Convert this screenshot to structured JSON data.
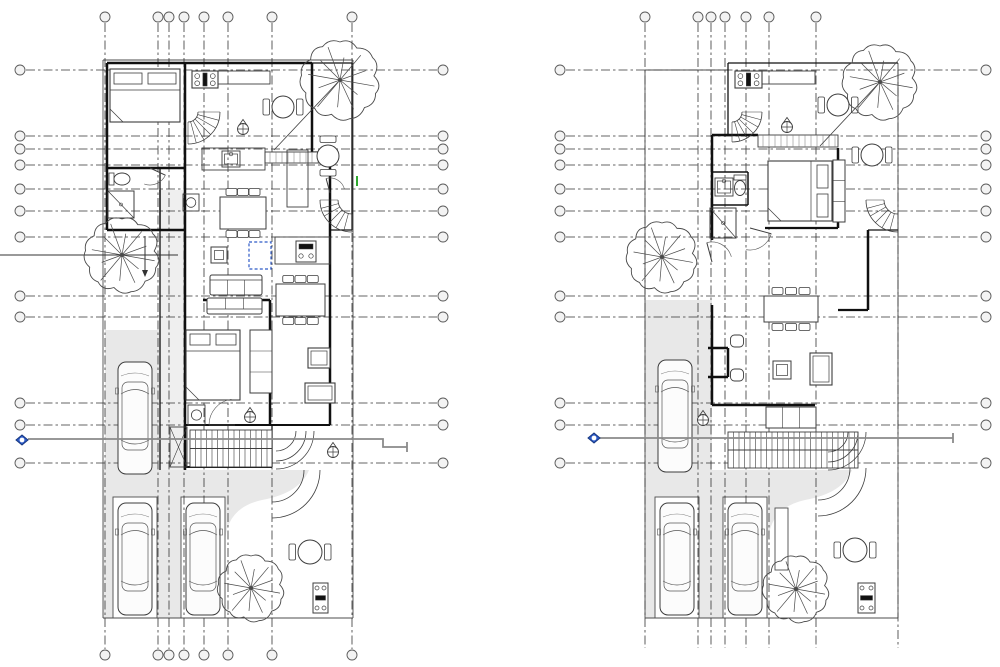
{
  "canvas": {
    "w": 1000,
    "h": 667,
    "bg": "#ffffff"
  },
  "palette": {
    "line": "#2f2f2f",
    "wall": "#101010",
    "furn": "#3d3d3d",
    "site": "#4d4d4d",
    "grid": "#343434",
    "gray_fill": "#e8e8e8",
    "gray_fill_light": "#efefef",
    "section_gray": "#8a8a8a",
    "accent_blue": "#2e5bc7",
    "accent_blue_dark": "#17377e",
    "green": "#18a018",
    "bubble_fill": "#f3f3f3",
    "tree": "#4a4a4a",
    "white": "#ffffff"
  },
  "plans": [
    {
      "name": "first-floor-plan",
      "grid": {
        "vx": [
          105,
          158,
          169,
          184,
          204,
          228,
          272,
          352
        ],
        "v_y1": 23,
        "v_y2": 649,
        "bubble_top_y": 17,
        "bubble_bottom_y": 655,
        "top_bubbles": true,
        "bottom_bubbles": true,
        "hy": [
          70,
          136,
          149,
          165,
          189,
          211,
          237,
          296,
          317,
          403,
          425,
          463
        ],
        "h_x1": 26,
        "h_x2": 437,
        "bubble_left_x": 20,
        "bubble_right_x": 443,
        "extra_dash": []
      },
      "fills": [
        {
          "t": "rect",
          "x": 103,
          "y": 470,
          "w": 250,
          "h": 148,
          "fill": "#e8e8e8"
        },
        {
          "t": "rect",
          "x": 105,
          "y": 330,
          "w": 55,
          "h": 140,
          "fill": "#e8e8e8"
        },
        {
          "t": "rect",
          "x": 160,
          "y": 190,
          "w": 25,
          "h": 280,
          "fill": "#efefef"
        },
        {
          "t": "path",
          "d": "M225,618 L225,545 Q225,508 262,500 Q300,493 309,470 L353,470 L353,618 Z",
          "fill": "#ffffff"
        },
        {
          "t": "rect",
          "x": 113,
          "y": 497,
          "w": 44,
          "h": 121,
          "fill": "#ffffff",
          "sw": 0.9
        },
        {
          "t": "rect",
          "x": 181,
          "y": 497,
          "w": 44,
          "h": 121,
          "fill": "#ffffff",
          "sw": 0.9
        }
      ],
      "site": [
        "M103,60 H353",
        "M353,60 V618",
        "M103,618 H353",
        "M103,60 V618"
      ],
      "walls": [
        {
          "d": "M107,63 H312",
          "w": 2.5
        },
        {
          "d": "M107,63 V230",
          "w": 2.5
        },
        {
          "d": "M107,168 H185",
          "w": 2.5
        },
        {
          "d": "M107,230 H185",
          "w": 2.5
        },
        {
          "d": "M185,63 V470",
          "w": 2.5
        },
        {
          "d": "M312,63 V152",
          "w": 2.5
        },
        {
          "d": "M330,163 V425",
          "w": 2.5
        },
        {
          "d": "M203,300 H270",
          "w": 2.5
        },
        {
          "d": "M270,300 V332",
          "w": 2.5
        },
        {
          "d": "M270,391 V425",
          "w": 2.5
        },
        {
          "d": "M185,425 H330",
          "w": 2
        },
        {
          "d": "M185,467 H272",
          "w": 2
        },
        {
          "d": "M312,63 H352",
          "w": 1.3
        },
        {
          "d": "M352,63 V230",
          "w": 1.3
        },
        {
          "d": "M330,230 H352",
          "w": 1.3
        },
        {
          "d": "M160,168 V230",
          "w": 1.3
        },
        {
          "d": "M160,190 V470",
          "w": 1.3
        },
        {
          "d": "M312,152 H330",
          "w": 1.3
        },
        {
          "d": "M272,425 V467",
          "w": 1.3
        }
      ],
      "symbols": [
        {
          "t": "band",
          "x": 265,
          "y": 152,
          "w": 65,
          "h": 11
        },
        {
          "t": "stove",
          "x": 192,
          "y": 71,
          "w": 26,
          "h": 17
        },
        {
          "t": "counter",
          "x": 218,
          "y": 71,
          "w": 52,
          "h": 13
        },
        {
          "t": "counter",
          "x": 202,
          "y": 148,
          "w": 63,
          "h": 22
        },
        {
          "t": "sink",
          "x": 222,
          "y": 151,
          "w": 18,
          "h": 16
        },
        {
          "t": "counter",
          "x": 287,
          "y": 150,
          "w": 21,
          "h": 57
        },
        {
          "t": "counter",
          "x": 275,
          "y": 237,
          "w": 55,
          "h": 27
        },
        {
          "t": "appliance",
          "x": 296,
          "y": 241,
          "w": 20,
          "h": 21
        },
        {
          "t": "bed",
          "x": 110,
          "y": 69,
          "w": 70,
          "h": 53,
          "hd": "top"
        },
        {
          "t": "bed",
          "x": 186,
          "y": 330,
          "w": 54,
          "h": 70,
          "hd": "top"
        },
        {
          "t": "sofa",
          "x": 210,
          "y": 275,
          "w": 52,
          "h": 20,
          "bk": "top"
        },
        {
          "t": "sofa",
          "x": 207,
          "y": 298,
          "w": 55,
          "h": 16,
          "bk": "bottom"
        },
        {
          "t": "rtable",
          "x": 283,
          "y": 107,
          "r": 11,
          "ch": "lr"
        },
        {
          "t": "rtable",
          "x": 328,
          "y": 156,
          "r": 11,
          "ch": "tb"
        },
        {
          "t": "rtable",
          "x": 310,
          "y": 552,
          "r": 12,
          "ch": "lr"
        },
        {
          "t": "dtable",
          "x": 220,
          "y": 197,
          "w": 46,
          "h": 32
        },
        {
          "t": "dtable",
          "x": 276,
          "y": 284,
          "w": 49,
          "h": 32
        },
        {
          "t": "stable",
          "x": 211,
          "y": 247,
          "s": 16
        },
        {
          "t": "wardrobe",
          "x": 250,
          "y": 330,
          "w": 22,
          "h": 63
        },
        {
          "t": "armchair",
          "x": 308,
          "y": 348,
          "w": 22,
          "h": 20
        },
        {
          "t": "armchair",
          "x": 305,
          "y": 383,
          "w": 30,
          "h": 20
        },
        {
          "t": "toilet",
          "x": 122,
          "y": 179,
          "o": "h"
        },
        {
          "t": "shower",
          "x": 108,
          "y": 191,
          "w": 26,
          "h": 27
        },
        {
          "t": "heater",
          "x": 183,
          "y": 194,
          "w": 16,
          "h": 17
        },
        {
          "t": "heater",
          "x": 188,
          "y": 405,
          "w": 17,
          "h": 20
        },
        {
          "t": "closetX",
          "x": 170,
          "y": 427,
          "w": 17,
          "h": 40
        },
        {
          "t": "stairs",
          "x": 190,
          "y": 430,
          "w": 82,
          "h": 37
        },
        {
          "t": "qstair",
          "x": 188,
          "y": 112,
          "r1": 10,
          "r2": 32,
          "a0": 0,
          "a1": 90
        },
        {
          "t": "qstair",
          "x": 352,
          "y": 200,
          "r1": 14,
          "r2": 32,
          "a0": 90,
          "a1": 180
        },
        {
          "t": "arcs",
          "x": 276,
          "y": 431,
          "rr": [
            20,
            30,
            38
          ],
          "a0": 0,
          "a1": 90
        },
        {
          "t": "arcs",
          "x": 272,
          "y": 470,
          "rr": [
            32,
            48
          ],
          "a0": 0,
          "a1": 90
        },
        {
          "t": "door",
          "x": 150,
          "y": 168,
          "r": 17,
          "a0": 25,
          "a1": 110
        },
        {
          "t": "door",
          "x": 235,
          "y": 425,
          "r": 26,
          "a0": 180,
          "a1": 262
        },
        {
          "t": "door",
          "x": 330,
          "y": 193,
          "r": 15,
          "a0": 255,
          "a1": 345
        },
        {
          "t": "spot",
          "x": 243,
          "y": 129
        },
        {
          "t": "spot",
          "x": 250,
          "y": 417
        },
        {
          "t": "spot",
          "x": 333,
          "y": 452
        },
        {
          "t": "line",
          "x1": 338,
          "y1": 82,
          "x2": 274,
          "y2": 150,
          "w": 0.8
        },
        {
          "t": "line",
          "x1": 357,
          "y1": 176,
          "x2": 357,
          "y2": 186,
          "w": 1.8,
          "c": "#18a018"
        },
        {
          "t": "line",
          "x1": 0,
          "y1": 255,
          "x2": 178,
          "y2": 255,
          "w": 1,
          "c": "#333333"
        },
        {
          "t": "line",
          "x1": 145,
          "y1": 236,
          "x2": 145,
          "y2": 271,
          "w": 1,
          "c": "#333333"
        },
        {
          "t": "marker",
          "pts": "142,270 148,270 145,277"
        },
        {
          "t": "bbq",
          "x": 313,
          "y": 583,
          "w": 15,
          "h": 30
        },
        {
          "t": "selbox",
          "x": 249,
          "y": 242,
          "w": 22,
          "h": 27
        },
        {
          "t": "car",
          "x": 118,
          "y": 362,
          "w": 34,
          "h": 112
        },
        {
          "t": "car",
          "x": 118,
          "y": 503,
          "w": 34,
          "h": 112
        },
        {
          "t": "car",
          "x": 186,
          "y": 503,
          "w": 34,
          "h": 112
        }
      ],
      "section": {
        "diamond": [
          22,
          440
        ],
        "line": "M28,439 H383 V447 H407",
        "tick": "M407,442 V452"
      },
      "trees": [
        {
          "x": 340,
          "y": 80,
          "r": 38
        },
        {
          "x": 122,
          "y": 255,
          "r": 36
        },
        {
          "x": 251,
          "y": 588,
          "r": 32
        }
      ]
    },
    {
      "name": "second-floor-plan",
      "grid": {
        "vx": [
          645,
          698,
          711,
          725,
          746,
          769,
          816
        ],
        "v_y1": 23,
        "v_y2": 648,
        "bubble_top_y": 17,
        "bubble_bottom_y": 655,
        "top_bubbles": true,
        "bottom_bubbles": false,
        "hy": [
          70,
          136,
          149,
          165,
          189,
          211,
          237,
          296,
          317,
          403,
          425,
          463
        ],
        "h_x1": 566,
        "h_x2": 980,
        "bubble_left_x": 560,
        "bubble_right_x": 986,
        "extra_dash": [
          {
            "x1": 898,
            "y1": 70,
            "x2": 898,
            "y2": 648
          }
        ]
      },
      "fills": [
        {
          "t": "rect",
          "x": 645,
          "y": 470,
          "w": 253,
          "h": 148,
          "fill": "#e8e8e8"
        },
        {
          "t": "rect",
          "x": 645,
          "y": 300,
          "w": 67,
          "h": 170,
          "fill": "#e8e8e8"
        },
        {
          "t": "path",
          "d": "M768,618 L768,545 Q768,508 805,500 Q843,493 852,470 L898,470 L898,618 Z",
          "fill": "#ffffff"
        },
        {
          "t": "rect",
          "x": 655,
          "y": 497,
          "w": 44,
          "h": 121,
          "fill": "#ffffff",
          "sw": 0.9
        },
        {
          "t": "rect",
          "x": 723,
          "y": 497,
          "w": 44,
          "h": 121,
          "fill": "#ffffff",
          "sw": 0.9
        },
        {
          "t": "rect",
          "x": 775,
          "y": 508,
          "w": 13,
          "h": 62,
          "fill": "#ffffff",
          "sw": 0.9
        }
      ],
      "site": [
        "M645,70 H728",
        "M645,70 V618",
        "M645,618 H898",
        "M898,63 V618"
      ],
      "walls": [
        {
          "d": "M712,135 H758",
          "w": 2.5
        },
        {
          "d": "M712,135 V240",
          "w": 2.5
        },
        {
          "d": "M838,148 V228",
          "w": 2.5
        },
        {
          "d": "M765,228 H838",
          "w": 2.2
        },
        {
          "d": "M868,230 V310",
          "w": 2.5
        },
        {
          "d": "M838,310 H868",
          "w": 2.2
        },
        {
          "d": "M712,305 V405",
          "w": 2.5
        },
        {
          "d": "M712,405 H815",
          "w": 2.5
        },
        {
          "d": "M708,348 H728",
          "w": 2.5
        },
        {
          "d": "M728,348 V377",
          "w": 2.5
        },
        {
          "d": "M708,377 H728",
          "w": 2.5
        },
        {
          "d": "M712,172 H748",
          "w": 1.5
        },
        {
          "d": "M748,172 V205",
          "w": 1.5
        },
        {
          "d": "M712,205 H748",
          "w": 1.5
        },
        {
          "d": "M728,63 V135",
          "w": 1.3
        },
        {
          "d": "M728,63 H898",
          "w": 1.3
        },
        {
          "d": "M868,230 H898",
          "w": 1.3
        }
      ],
      "symbols": [
        {
          "t": "band",
          "x": 758,
          "y": 135,
          "w": 80,
          "h": 12
        },
        {
          "t": "stove",
          "x": 735,
          "y": 71,
          "w": 27,
          "h": 17
        },
        {
          "t": "counter",
          "x": 762,
          "y": 71,
          "w": 53,
          "h": 13
        },
        {
          "t": "rtable",
          "x": 838,
          "y": 105,
          "r": 11,
          "ch": "lr"
        },
        {
          "t": "rtable",
          "x": 872,
          "y": 155,
          "r": 11,
          "ch": "lr"
        },
        {
          "t": "rtable",
          "x": 855,
          "y": 550,
          "r": 12,
          "ch": "lr"
        },
        {
          "t": "bed",
          "x": 768,
          "y": 161,
          "w": 64,
          "h": 60,
          "hd": "right"
        },
        {
          "t": "wardrobe",
          "x": 833,
          "y": 160,
          "w": 12,
          "h": 62
        },
        {
          "t": "sink",
          "x": 715,
          "y": 178,
          "w": 18,
          "h": 18
        },
        {
          "t": "toilet",
          "x": 740,
          "y": 188,
          "o": "v"
        },
        {
          "t": "shower",
          "x": 710,
          "y": 208,
          "w": 26,
          "h": 30
        },
        {
          "t": "dtable",
          "x": 764,
          "y": 296,
          "w": 54,
          "h": 26
        },
        {
          "t": "stable",
          "x": 773,
          "y": 361,
          "s": 18
        },
        {
          "t": "pouf",
          "x": 737,
          "y": 341
        },
        {
          "t": "pouf",
          "x": 737,
          "y": 375
        },
        {
          "t": "armchair",
          "x": 810,
          "y": 353,
          "w": 22,
          "h": 32
        },
        {
          "t": "wardrobe",
          "x": 766,
          "y": 407,
          "w": 50,
          "h": 21
        },
        {
          "t": "stairs",
          "x": 728,
          "y": 432,
          "w": 130,
          "h": 36
        },
        {
          "t": "qstair",
          "x": 732,
          "y": 112,
          "r1": 10,
          "r2": 30,
          "a0": 0,
          "a1": 90
        },
        {
          "t": "qstair",
          "x": 898,
          "y": 200,
          "r1": 14,
          "r2": 32,
          "a0": 90,
          "a1": 180
        },
        {
          "t": "arcs",
          "x": 828,
          "y": 432,
          "rr": [
            20,
            30,
            38
          ],
          "a0": 0,
          "a1": 90
        },
        {
          "t": "arcs",
          "x": 818,
          "y": 468,
          "rr": [
            32,
            48
          ],
          "a0": 0,
          "a1": 90
        },
        {
          "t": "door",
          "x": 750,
          "y": 228,
          "r": 22,
          "a0": 15,
          "a1": 100
        },
        {
          "t": "door",
          "x": 712,
          "y": 262,
          "r": 20,
          "a0": 255,
          "a1": 345
        },
        {
          "t": "spot",
          "x": 787,
          "y": 127
        },
        {
          "t": "spot",
          "x": 703,
          "y": 420
        },
        {
          "t": "line",
          "x1": 878,
          "y1": 84,
          "x2": 820,
          "y2": 146,
          "w": 0.8
        },
        {
          "t": "bbq",
          "x": 858,
          "y": 583,
          "w": 17,
          "h": 30
        },
        {
          "t": "car",
          "x": 658,
          "y": 360,
          "w": 34,
          "h": 112
        },
        {
          "t": "car",
          "x": 660,
          "y": 503,
          "w": 34,
          "h": 112
        },
        {
          "t": "car",
          "x": 728,
          "y": 503,
          "w": 34,
          "h": 112
        }
      ],
      "section": {
        "diamond": [
          594,
          438
        ],
        "line": "M600,438 H953",
        "tick": "M953,433 V443"
      },
      "trees": [
        {
          "x": 880,
          "y": 82,
          "r": 36
        },
        {
          "x": 662,
          "y": 257,
          "r": 34
        },
        {
          "x": 796,
          "y": 589,
          "r": 32
        }
      ]
    }
  ]
}
